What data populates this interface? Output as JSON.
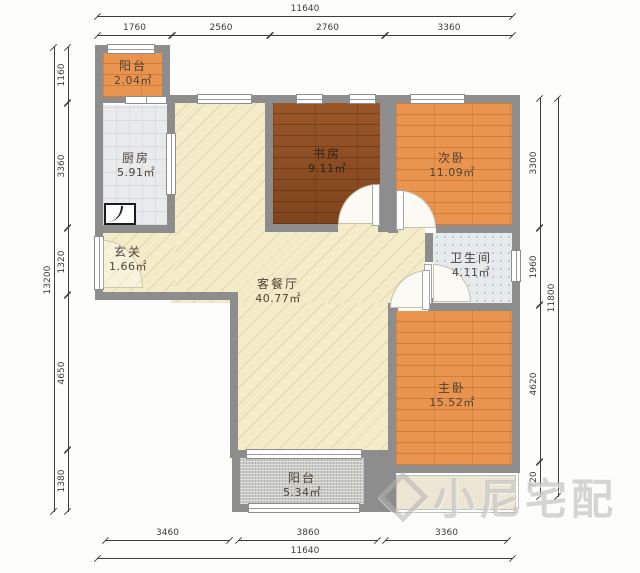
{
  "rooms": [
    {
      "id": "balcony-top",
      "name": "阳台",
      "area": "2.04㎡"
    },
    {
      "id": "kitchen",
      "name": "厨房",
      "area": "5.91㎡"
    },
    {
      "id": "entry",
      "name": "玄关",
      "area": "1.66㎡"
    },
    {
      "id": "study",
      "name": "书房",
      "area": "9.11㎡"
    },
    {
      "id": "bedroom-second",
      "name": "次卧",
      "area": "11.09㎡"
    },
    {
      "id": "bathroom",
      "name": "卫生间",
      "area": "4.11㎡"
    },
    {
      "id": "living-dining",
      "name": "客餐厅",
      "area": "40.77㎡"
    },
    {
      "id": "bedroom-master",
      "name": "主卧",
      "area": "15.52㎡"
    },
    {
      "id": "balcony-bottom",
      "name": "阳台",
      "area": "5.34㎡"
    }
  ],
  "dimensions": {
    "top": {
      "total": "11640",
      "segments": [
        "1760",
        "2560",
        "2760",
        "3360"
      ]
    },
    "bottom": {
      "total": "11640",
      "segments": [
        "3460",
        "3860",
        "3360"
      ]
    },
    "left": {
      "total": "13200",
      "segments": [
        "1160",
        "3360",
        "1320",
        "4650",
        "1380"
      ]
    },
    "right": {
      "total": "11800",
      "segments": [
        "3300",
        "1960",
        "4620",
        "720"
      ]
    }
  },
  "watermark": {
    "text": "小尼宅配"
  },
  "colors": {
    "wall": "#8d8d8d",
    "living_floor": "#f4ebc8",
    "study_floor": "#8b4a1f",
    "wood_floor": "#e9954f",
    "kitchen_floor": "#e9eaec",
    "bath_floor": "#e5eaed",
    "balcony_floor": "#c9c9c5",
    "dimension_ink": "#3d3d3d"
  }
}
